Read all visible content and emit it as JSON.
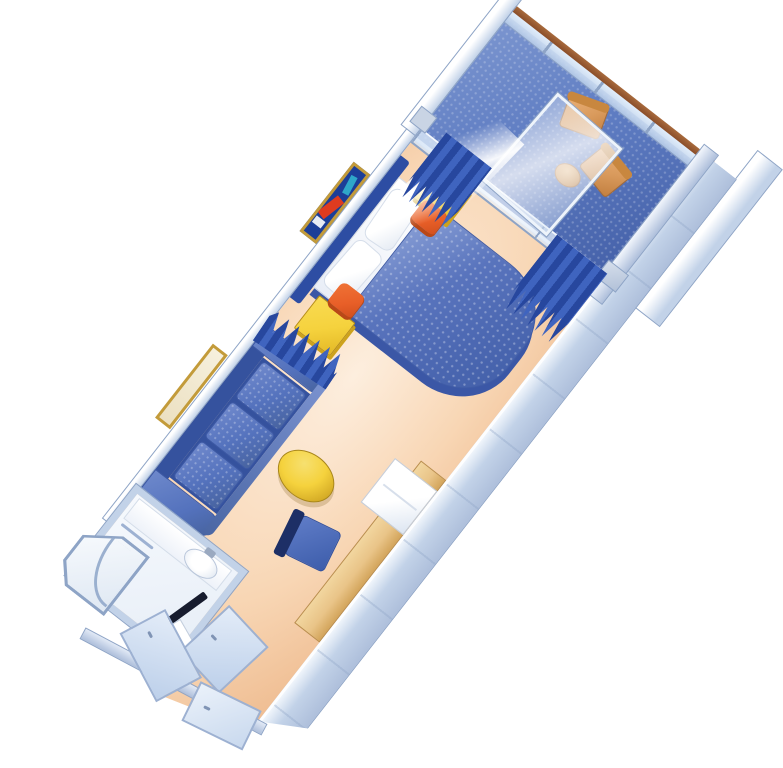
{
  "floorplan": {
    "type": "stateroom-isometric-floorplan",
    "style": "3d-cutaway illustration, no text labels",
    "rotation_deg": 38,
    "rooms": [
      {
        "id": "balcony",
        "label": "Private balcony",
        "items": [
          "glass railing with wood handrail",
          "balcony divider panels",
          "deck chair",
          "deck chair",
          "round cocktail table",
          "sliding glass door pane"
        ]
      },
      {
        "id": "bedroom",
        "label": "Sleeping area",
        "items": [
          "double bed with royal-blue quilted cover",
          "white sheet section",
          "pillow",
          "pillow",
          "navy headboard",
          "yellow nightstand",
          "yellow nightstand",
          "orange ottoman",
          "orange ottoman",
          "framed abstract wall art",
          "navy pleated curtain left",
          "navy pleated curtain right",
          "navy room-divider curtain"
        ]
      },
      {
        "id": "living",
        "label": "Sitting area",
        "items": [
          "royal-blue three-seat sofa",
          "gold oval coffee table",
          "vanity desk along wall",
          "white mini-fridge cabinet",
          "blue desk chair",
          "framed landscape wall art"
        ]
      },
      {
        "id": "bathroom",
        "label": "Bathroom",
        "items": [
          "corner shower with curved glass door",
          "wash basin with counter and faucet",
          "towel bar",
          "toilet",
          "dark door panel"
        ]
      },
      {
        "id": "entry",
        "label": "Entry hall",
        "items": [
          "cabin entry door",
          "closet door",
          "closet door",
          "wardrobe shelves",
          "angled end wall"
        ]
      }
    ]
  },
  "colors": {
    "wall_edge": "#8ea4c6",
    "wall_fill": "#c2d2e8",
    "wall_face": "#aebfdb",
    "floor_light": "#fdeede",
    "floor_mid": "#f8d6b4",
    "floor_deep": "#efbd92",
    "deck_blue": "#5e7cc2",
    "deck_dark": "#4460a8",
    "bed_blue": "#5974bd",
    "bed_dark": "#3b57a6",
    "headboard_navy": "#2d4da3",
    "sofa_blue": "#5472bd",
    "sofa_dark": "#35529e",
    "curtain_navy": "#27479e",
    "curtain_blue": "#3f64bf",
    "accent_yellow": "#f5d23d",
    "accent_yellow_dark": "#cda21c",
    "accent_orange": "#e85f28",
    "accent_orange_dark": "#b94817",
    "deck_tan": "#d99a5c",
    "tan_dark": "#a96c33",
    "rail_brown": "#8a4e2a",
    "desk_wood": "#e9c488",
    "gold_frame": "#c39b3a",
    "art_navy": "#1c3e98",
    "art_red": "#df3b1f",
    "art_teal": "#2fa7c9",
    "chair_navy": "#1d2f66",
    "fixture_shade": "#dce5f1",
    "door_dark": "#171c2e",
    "background": "#ffffff"
  }
}
